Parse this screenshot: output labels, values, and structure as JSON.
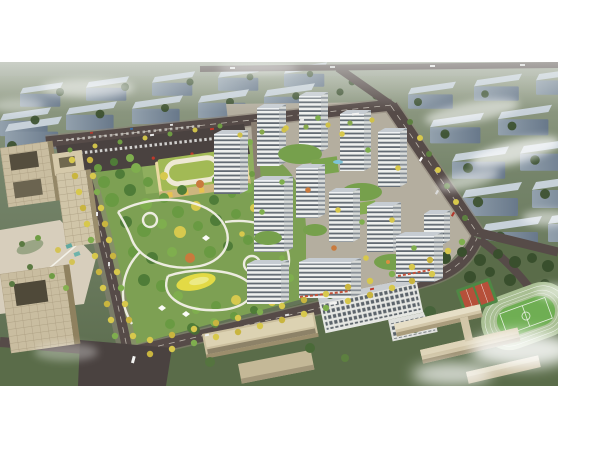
{
  "scene": {
    "type": "aerial-architectural-rendering",
    "subject": "residential masterplan with central park, kindergarten, offices and school sports field",
    "view": "oblique bird's-eye",
    "canvas": {
      "width": 600,
      "height": 450
    },
    "frame": {
      "left": 0,
      "top": 62,
      "width": 558,
      "height": 324
    },
    "elements": [
      "background-city-blocks",
      "distant-road",
      "perimeter-roads",
      "parking-lot",
      "kindergarten",
      "central-park",
      "playground",
      "park-paths",
      "residential-towers",
      "courtyard-gardens",
      "retail-frontage",
      "office-towers",
      "office-plaza",
      "boulevard-trees",
      "existing-apartment-blocks",
      "school-buildings",
      "running-track",
      "basketball-courts",
      "clouds"
    ],
    "palette": {
      "border_white": "#ffffff",
      "bg_top": "#9aa38e",
      "bg_mid": "#75846a",
      "bg_bottom": "#5a6b4c",
      "bg_slab_top": "#c7d1d9",
      "bg_slab_face_hi": "#93a1ad",
      "bg_slab_face_lo": "#68788a",
      "haze": "#f2f5f3",
      "road": "#564b48",
      "road_edge": "#8d8478",
      "road_line": "#ddd8cc",
      "asphalt": "#4a4240",
      "site_paving": "#b4ae9f",
      "park_green": "#7da053",
      "tree_dark": "#3f682e",
      "tree_mid": "#699a42",
      "tree_light": "#7fae4e",
      "tree_deep": "#4f7c38",
      "tree_yellow": "#d6c94e",
      "tree_orange": "#c97a3d",
      "bg_tree": "#3c512f",
      "path_white": "#f3f1e8",
      "playground_yellow": "#e3da45",
      "tower_face": "#eef0ee",
      "tower_stripe": "#4a545e",
      "tower_side": "#d7dad8",
      "tower_side_stripe": "#7e868e",
      "tower_roof": "#c6ccd2",
      "courtyard_green": "#76a04c",
      "pool_blue": "#7fc4d8",
      "retail_red": "#c4523a",
      "kindergarten_roof": "#a2ba55",
      "kindergarten_wall": "#ead9a2",
      "office_beige": "#c9bda0",
      "office_court": "#554e3e",
      "plaza": "#d7cebc",
      "slab_tan": "#cbbf9e",
      "slab_white": "#e6e7e3",
      "track_ring": "#a9bf93",
      "track_infield": "#6fae53",
      "court_red": "#b6503a",
      "court_green": "#4f8745",
      "school_tan": "#d2c6a8",
      "cloud": "#ffffff"
    }
  }
}
